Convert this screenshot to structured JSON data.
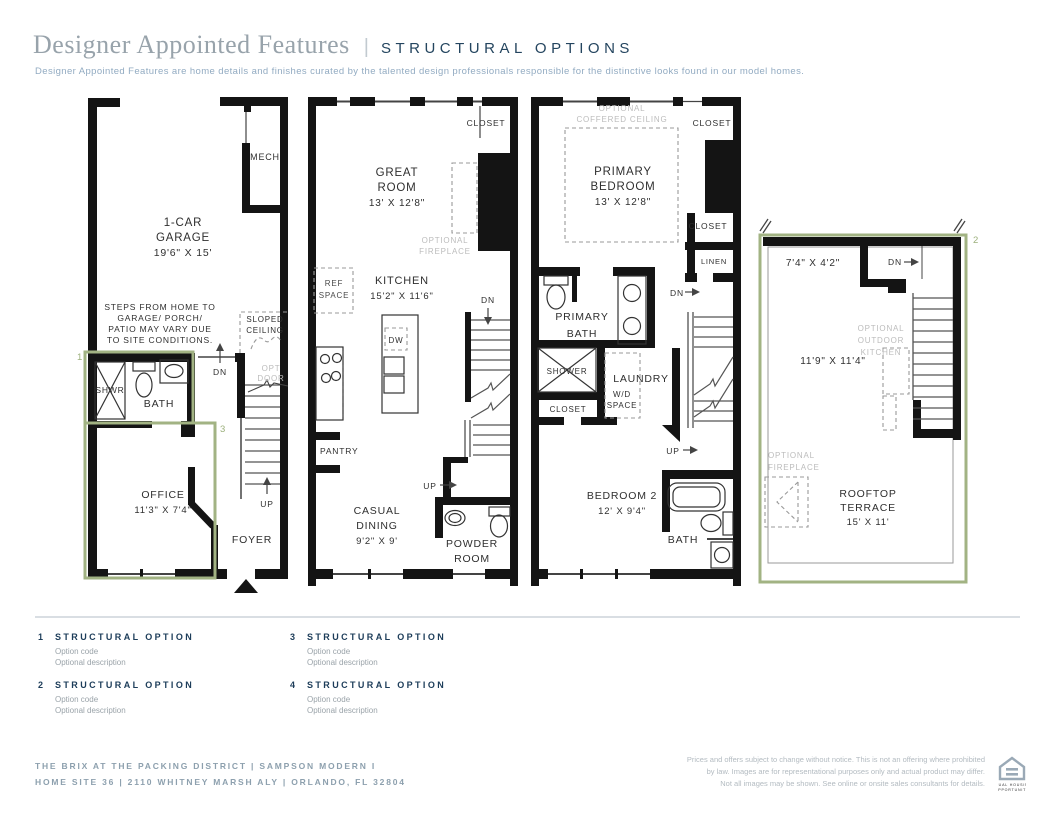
{
  "header": {
    "title": "Designer Appointed Features",
    "separator": "|",
    "tagline": "STRUCTURAL OPTIONS",
    "description": "Designer Appointed Features are home details and finishes curated by the talented design professionals responsible for the distinctive looks found in our model homes."
  },
  "plans": {
    "first_floor": {
      "mech": "MECH",
      "garage": [
        "1-CAR",
        "GARAGE",
        "19'6\" X 15'"
      ],
      "steps_note": [
        "STEPS FROM HOME TO",
        "GARAGE/ PORCH/",
        "PATIO MAY VARY DUE",
        "TO SITE CONDITIONS."
      ],
      "sloped_ceiling": [
        "SLOPED",
        "CEILING"
      ],
      "dn": "DN",
      "opt_door": [
        "OPT",
        "DOOR"
      ],
      "shwr": "SHWR",
      "bath": "BATH",
      "office": [
        "OFFICE",
        "11'3\" X 7'4\""
      ],
      "up": "UP",
      "foyer": "FOYER",
      "marker_1": "1",
      "marker_3": "3"
    },
    "second_floor": {
      "closet": "CLOSET",
      "great_room": [
        "GREAT",
        "ROOM",
        "13' X 12'8\""
      ],
      "optional_fireplace": [
        "OPTIONAL",
        "FIREPLACE"
      ],
      "kitchen": [
        "KITCHEN",
        "15'2\" X 11'6\""
      ],
      "ref_space": [
        "REF",
        "SPACE"
      ],
      "dw": "DW",
      "dn": "DN",
      "pantry": "PANTRY",
      "up": "UP",
      "casual_dining": [
        "CASUAL",
        "DINING",
        "9'2\" X 9'"
      ],
      "powder_room": [
        "POWDER",
        "ROOM"
      ]
    },
    "third_floor": {
      "optional_coffered_ceiling": [
        "OPTIONAL",
        "COFFERED CEILING"
      ],
      "closet_top": "CLOSET",
      "primary_bedroom": [
        "PRIMARY",
        "BEDROOM",
        "13' X 12'8\""
      ],
      "closet_mid": "CLOSET",
      "linen": "LINEN",
      "primary_bath": [
        "PRIMARY",
        "BATH"
      ],
      "dn": "DN",
      "shower": "SHOWER",
      "closet_hall": "CLOSET",
      "laundry": "LAUNDRY",
      "wd_space": [
        "W/D",
        "SPACE"
      ],
      "up": "UP",
      "bedroom_2": [
        "BEDROOM 2",
        "12' X 9'4\""
      ],
      "bath": "BATH"
    },
    "rooftop": {
      "marker_2": "2",
      "upper_dim": "7'4\" X 4'2\"",
      "dn": "DN",
      "optional_outdoor_kitchen": [
        "OPTIONAL",
        "OUTDOOR",
        "KITCHEN"
      ],
      "mid_dim": "11'9\" X 11'4\"",
      "optional_fireplace": [
        "OPTIONAL",
        "FIREPLACE"
      ],
      "rooftop_terrace": [
        "ROOFTOP",
        "TERRACE",
        "15' X 11'"
      ]
    }
  },
  "legend": {
    "items": [
      {
        "num": "1",
        "title": "STRUCTURAL OPTION",
        "code": "Option code",
        "desc": "Optional description"
      },
      {
        "num": "2",
        "title": "STRUCTURAL OPTION",
        "code": "Option code",
        "desc": "Optional description"
      },
      {
        "num": "3",
        "title": "STRUCTURAL OPTION",
        "code": "Option code",
        "desc": "Optional description"
      },
      {
        "num": "4",
        "title": "STRUCTURAL OPTION",
        "code": "Option code",
        "desc": "Optional description"
      }
    ]
  },
  "footer": {
    "community": "THE BRIX AT THE PACKING DISTRICT | SAMPSON MODERN I",
    "address": "HOME SITE 36 | 2110 WHITNEY MARSH ALY | ORLANDO, FL 32804",
    "legal": [
      "Prices and offers subject to change without notice. This is not an offering where prohibited",
      "by law. Images are for representational purposes only and actual product may differ.",
      "Not all images may be shown. See online or onsite sales consultants for details."
    ],
    "equal_housing": [
      "EQUAL HOUSING",
      "OPPORTUNITY"
    ]
  },
  "colors": {
    "navy": "#1c3c59",
    "title_gray": "#98a3ab",
    "subtitle_blue": "#92abc2",
    "wall_black": "#141414",
    "optional_gray": "#bcbcbc",
    "option_green": "#a2b383"
  }
}
